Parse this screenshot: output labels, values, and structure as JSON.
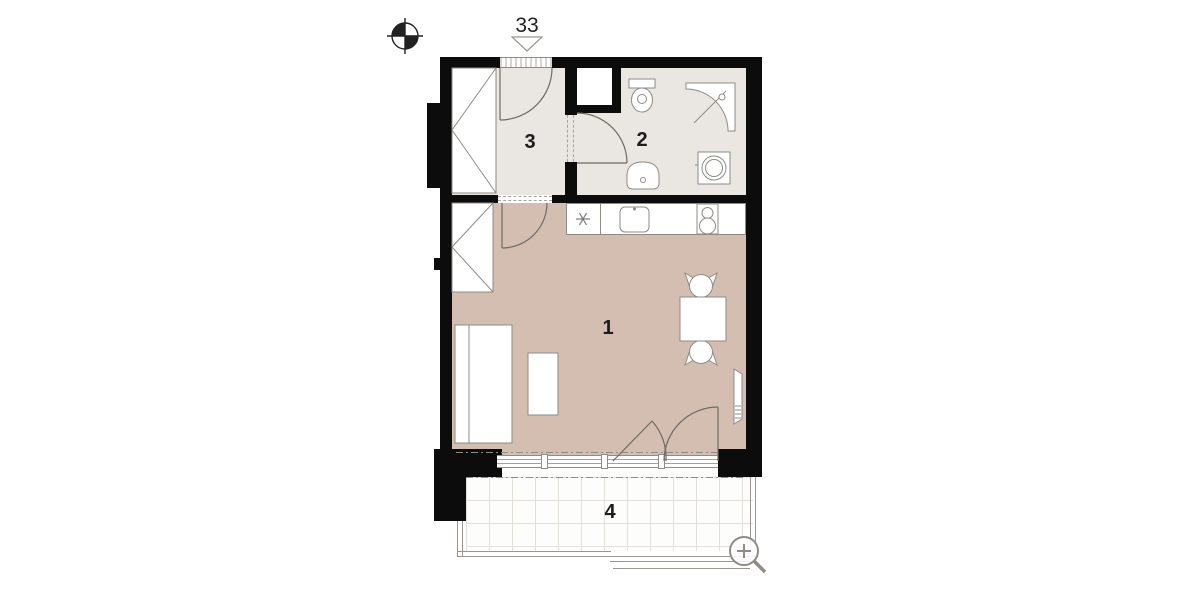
{
  "plan": {
    "unit_label": "33",
    "rooms": [
      {
        "id": "living-room",
        "label": "1"
      },
      {
        "id": "bathroom",
        "label": "2"
      },
      {
        "id": "hall",
        "label": "3"
      },
      {
        "id": "balcony",
        "label": "4"
      }
    ],
    "icons": [
      "compass-icon",
      "entrance-arrow-icon",
      "zoom-in-icon"
    ],
    "colors": {
      "wall": "#0c0c0c",
      "living_floor": "#d3beb1",
      "service_floor": "#eae6e1",
      "outline": "#8f8b85"
    }
  }
}
